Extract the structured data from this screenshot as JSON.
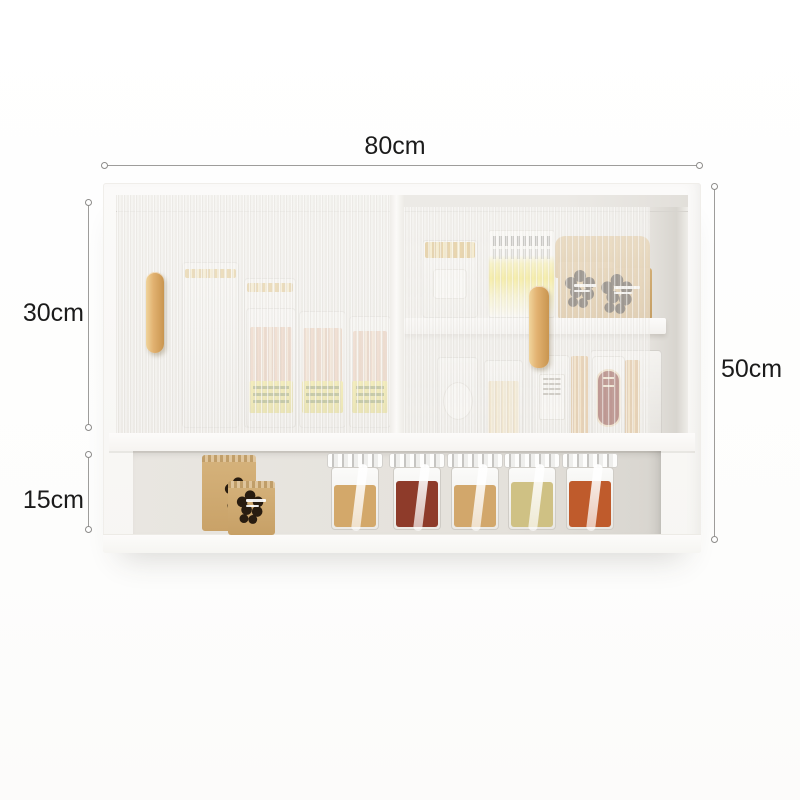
{
  "subject": "white wall-mounted kitchen cabinet with fluted glass sliding doors, jars and kraft spice bags",
  "dimensions": {
    "width": {
      "label": "80cm",
      "value": 80,
      "unit": "cm",
      "edge": "top"
    },
    "total_height": {
      "label": "50cm",
      "value": 50,
      "unit": "cm",
      "edge": "right"
    },
    "upper_section": {
      "label": "30cm",
      "value": 30,
      "unit": "cm",
      "edge": "left-upper"
    },
    "lower_section": {
      "label": "15cm",
      "value": 15,
      "unit": "cm",
      "edge": "left-lower"
    }
  },
  "colors": {
    "background": "#fdfdfc",
    "dimension_line": "#9e9d9b",
    "dimension_text": "#1b1b1b",
    "cabinet_frame": "#fbfaf9",
    "interior_back": "#eceae6",
    "niche_back": "#e4e1db",
    "glass_rib": "#d5d2cc",
    "wood_handle": "#e2b271",
    "kraft": "#cfa973",
    "logo_dark": "#281c10",
    "gold_lid": "#d9b15e",
    "label_yellow": "#efe06a",
    "red_label": "#7c2a22",
    "spice_fills": [
      "#d3a86a",
      "#8e3b2a",
      "#d2a76b",
      "#cfc184",
      "#bf5b2c"
    ]
  }
}
